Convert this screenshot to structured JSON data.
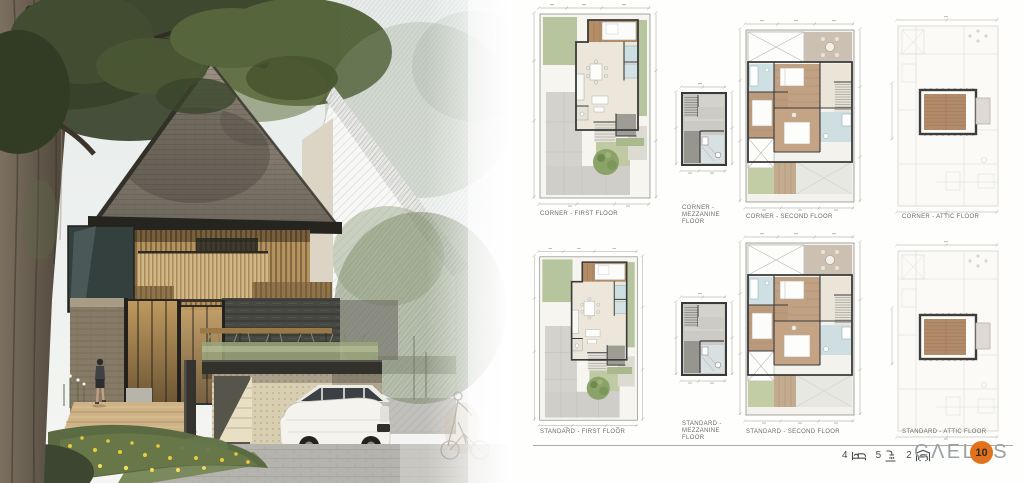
{
  "board": {
    "title": "house exterior render with floor plan sheet",
    "footer": {
      "stats": [
        {
          "icon": "bed-icon",
          "value": "4"
        },
        {
          "icon": "shower-icon",
          "value": "5"
        },
        {
          "icon": "car-icon",
          "value": "2"
        }
      ],
      "brand": "CΛELUS",
      "badge": "10",
      "brand_color": "#9aa1a6",
      "badge_color": "#e2711d"
    },
    "plans": [
      {
        "id": "corner-first",
        "label": "CORNER - FIRST FLOOR"
      },
      {
        "id": "corner-mezzanine",
        "label": "CORNER - MEZZANINE FLOOR"
      },
      {
        "id": "corner-second",
        "label": "CORNER - SECOND FLOOR"
      },
      {
        "id": "corner-attic",
        "label": "CORNER - ATTIC FLOOR"
      },
      {
        "id": "standard-first",
        "label": "STANDARD - FIRST FLOOR"
      },
      {
        "id": "standard-mezzanine",
        "label": "STANDARD - MEZZANINE FLOOR"
      },
      {
        "id": "standard-second",
        "label": "STANDARD - SECOND FLOOR"
      },
      {
        "id": "standard-attic",
        "label": "STANDARD - ATTIC FLOOR"
      }
    ]
  }
}
